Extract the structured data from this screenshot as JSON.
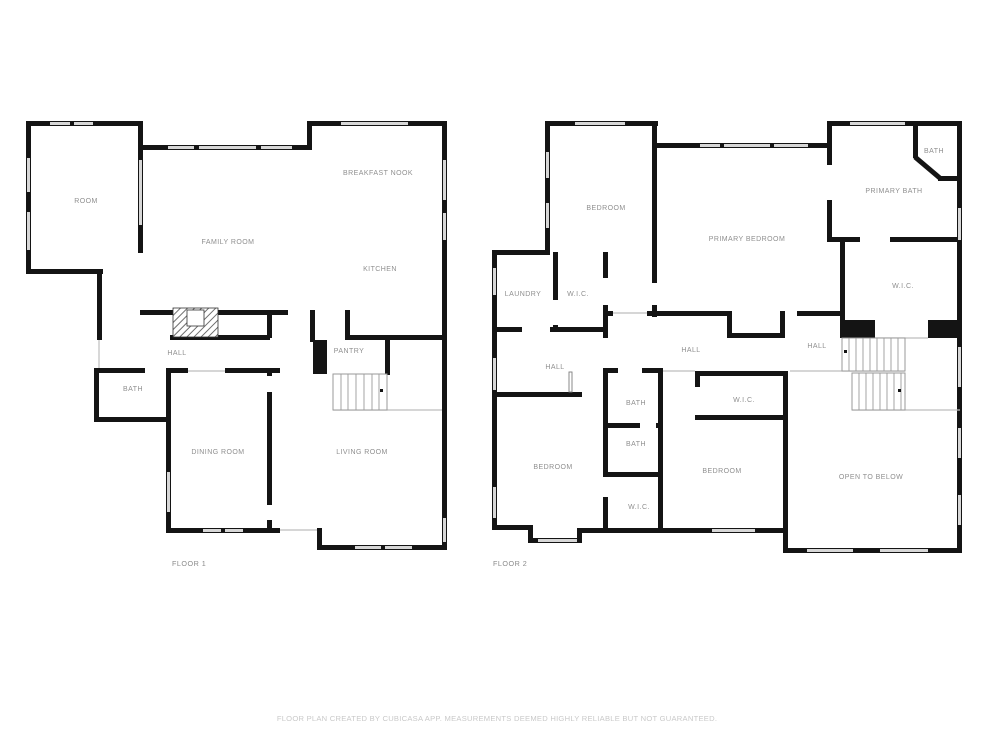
{
  "floor1": {
    "name": "FLOOR 1",
    "rooms": {
      "room": "ROOM",
      "family_room": "FAMILY ROOM",
      "breakfast_nook": "BREAKFAST NOOK",
      "kitchen": "KITCHEN",
      "hall": "HALL",
      "pantry": "PANTRY",
      "bath": "BATH",
      "dining_room": "DINING ROOM",
      "living_room": "LIVING ROOM"
    }
  },
  "floor2": {
    "name": "FLOOR 2",
    "rooms": {
      "bedroom_top": "BEDROOM",
      "laundry": "LAUNDRY",
      "wic_laundry": "W.I.C.",
      "primary_bedroom": "PRIMARY BEDROOM",
      "bath_corner": "BATH",
      "primary_bath": "PRIMARY BATH",
      "wic_primary": "W.I.C.",
      "hall_west": "HALL",
      "hall_center": "HALL",
      "hall_east": "HALL",
      "bath_upper": "BATH",
      "bath_lower": "BATH",
      "bedroom_west": "BEDROOM",
      "wic_column": "W.I.C.",
      "wic_center": "W.I.C.",
      "bedroom_center": "BEDROOM",
      "open_to_below": "OPEN TO BELOW"
    }
  },
  "footer": {
    "disclaimer": "FLOOR PLAN CREATED BY CUBICASA APP. MEASUREMENTS DEEMED HIGHLY RELIABLE BUT NOT GUARANTEED."
  },
  "colors": {
    "wall": "#141414",
    "window": "#d7d7d7",
    "room_label": "#8f8f8f",
    "disclaimer_text": "#c9c9c9",
    "background": "#ffffff"
  }
}
